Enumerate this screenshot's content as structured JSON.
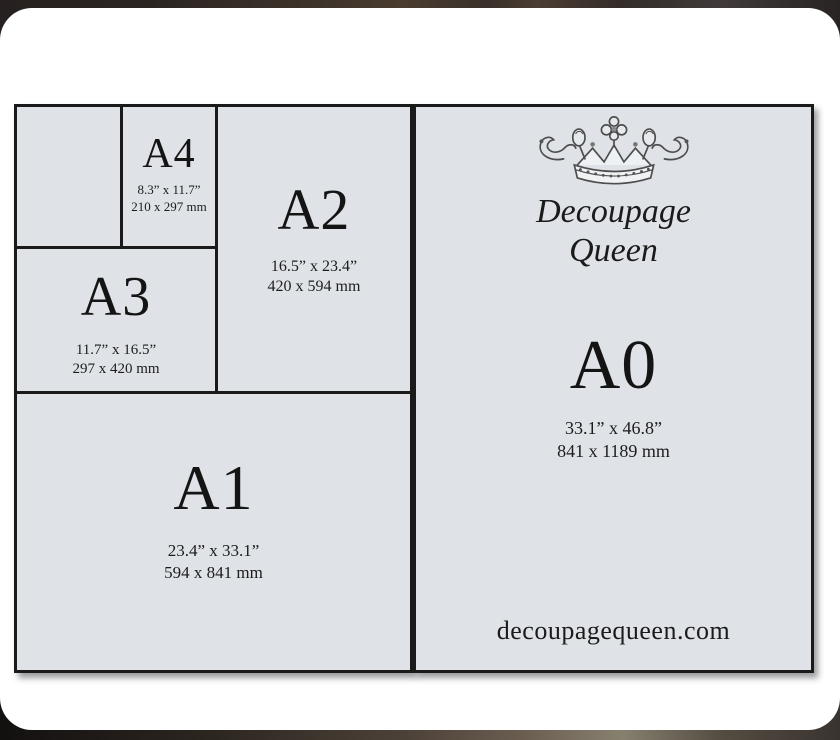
{
  "colors": {
    "panel_bg": "#dfe3e7",
    "line": "#1a1a1a",
    "card_bg": "#ffffff",
    "text": "#1c1c1c"
  },
  "brand": {
    "crown_icon": "crown-icon",
    "line1": "Decoupage",
    "line2": "Queen",
    "website": "decoupagequeen.com"
  },
  "sizes": {
    "a4": {
      "label": "A4",
      "inches": "8.3” x 11.7”",
      "mm": "210 x 297 mm"
    },
    "a3": {
      "label": "A3",
      "inches": "11.7” x 16.5”",
      "mm": "297 x 420 mm"
    },
    "a2": {
      "label": "A2",
      "inches": "16.5” x 23.4”",
      "mm": "420 x 594 mm"
    },
    "a1": {
      "label": "A1",
      "inches": "23.4” x 33.1”",
      "mm": "594 x 841 mm"
    },
    "a0": {
      "label": "A0",
      "inches": "33.1” x 46.8”",
      "mm": "841 x 1189 mm"
    }
  }
}
